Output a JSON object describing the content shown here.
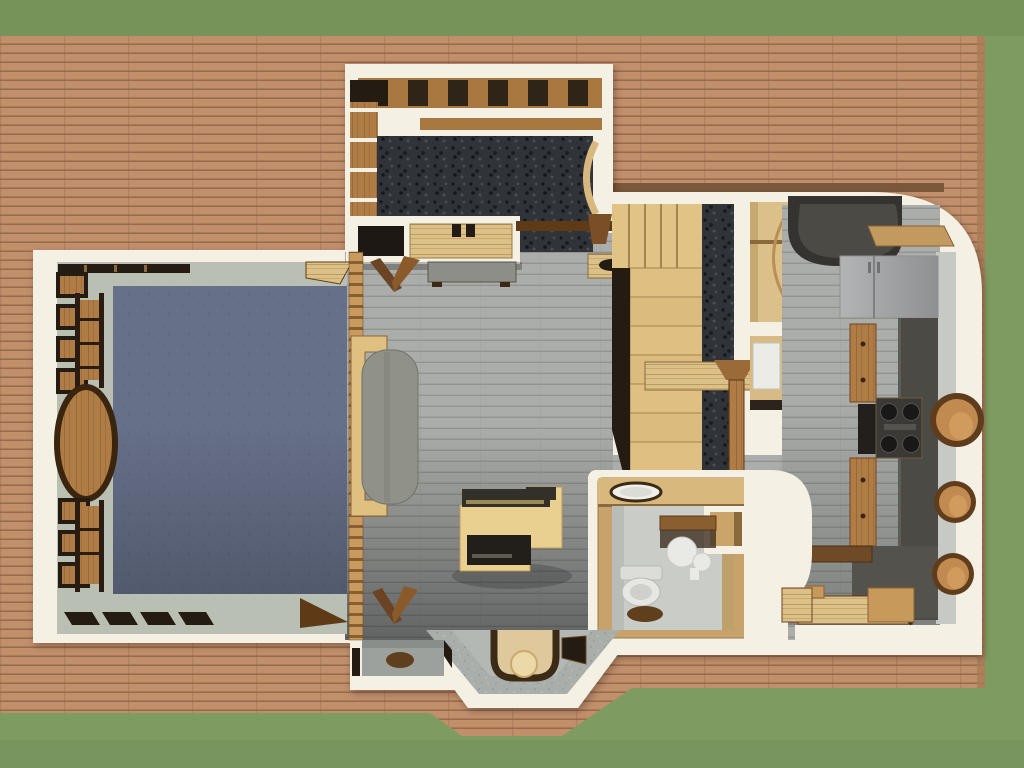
{
  "scene": {
    "title": "3D overhead dollhouse render of a house floor plan",
    "view": "top-down",
    "surroundings": [
      "lawn",
      "wrap-around wood deck"
    ]
  },
  "palette": {
    "grass": "#7e9c61",
    "grass_shade": "#6f8c55",
    "deck": "#c28f6b",
    "deck_line": "#916549",
    "wall": "#f4f1e4",
    "wall_face": "#b9bfb3",
    "floor": "#abadaa",
    "floor_line": "#90928c",
    "carpet_bedroom": "#677089",
    "carpet_dark": "#303338",
    "wood_light": "#e2c386",
    "wood_mid": "#b07c46",
    "wood_dark": "#5f3a17",
    "counter_dark": "#4b4a45",
    "appliance": "#a5a7a9",
    "fixture_white": "#e9eae6",
    "concrete": "#a9aeab",
    "bath_wall": "#c7a26b",
    "bath_counter": "#d8b87c",
    "cushion": "#90928a",
    "stone": "#8e8e88",
    "rug_brown": "#5f3f1c",
    "opening_dark": "#241c12"
  },
  "rooms": [
    {
      "id": "yard",
      "label": "lawn"
    },
    {
      "id": "deck",
      "label": "wood deck",
      "items": [
        "plank decking"
      ]
    },
    {
      "id": "sunroom",
      "label": "sunroom",
      "floor": "dark speckled carpet",
      "items": [
        "roof beams",
        "wall shelf column",
        "storage counter",
        "wood railing",
        "door arc"
      ]
    },
    {
      "id": "bedroom",
      "label": "bedroom study",
      "floor": "blue-gray carpet",
      "items": [
        "clerestory window strip",
        "wall shelf boxes",
        "ladder cabinets",
        "oval wood table",
        "slat room divider",
        "sofa",
        "corner shelf",
        "door wedge"
      ]
    },
    {
      "id": "living",
      "label": "living area",
      "floor": "gray plank floor",
      "items": [
        "writing desk",
        "stone-top bench",
        "folding wood panel",
        "hall dresser"
      ]
    },
    {
      "id": "stairs",
      "label": "l-shaped staircase",
      "items": [
        "upper landing",
        "lower treads",
        "dark stair runner",
        "newel post",
        "wood column"
      ]
    },
    {
      "id": "closets",
      "label": "hall closets",
      "items": [
        "wardrobe with door arc",
        "appliance box",
        "wood door panel"
      ]
    },
    {
      "id": "kitchen",
      "label": "galley kitchen",
      "items": [
        "curved breakfast bar",
        "refrigerator",
        "wood cabinets",
        "oven",
        "gas cooktop",
        "porthole windows",
        "sunken wood platform",
        "storage box",
        "bench slab"
      ]
    },
    {
      "id": "bathroom",
      "label": "bathroom",
      "items": [
        "vanity counter with sink",
        "wall shelf",
        "water heater cylinders",
        "toilet",
        "round rug",
        "storage cubby",
        "curved wall",
        "wood step"
      ]
    },
    {
      "id": "entry",
      "label": "bay entry vestibule",
      "items": [
        "speckled angled walls",
        "arched door mat",
        "round mat",
        "side window openings"
      ]
    },
    {
      "id": "alcove",
      "label": "entry alcove",
      "items": [
        "round rug",
        "folding wood panel",
        "slit window"
      ]
    }
  ]
}
